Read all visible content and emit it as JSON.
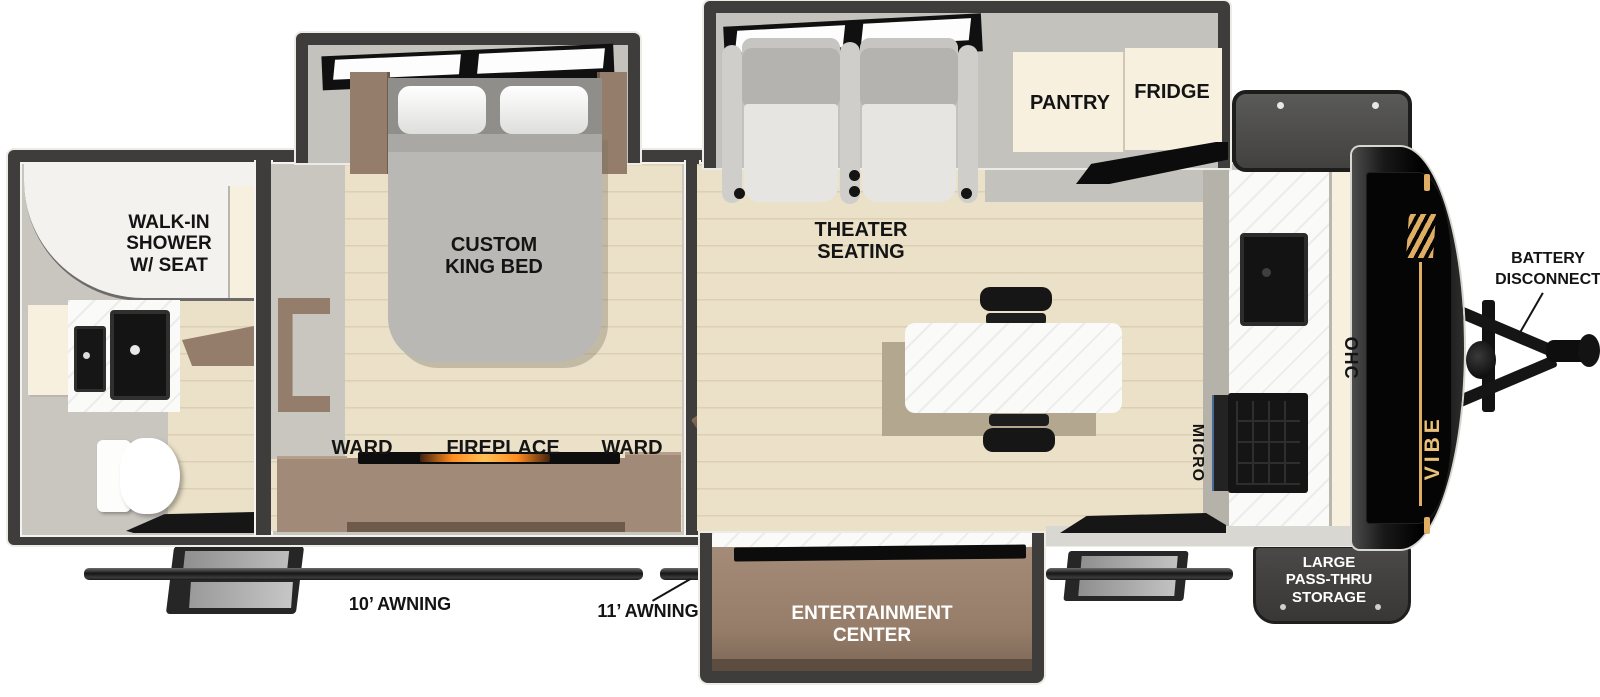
{
  "brand": {
    "logo": "VIBE"
  },
  "colors": {
    "wall": "#3e3d3b",
    "floor_wood": "#ebe1c8",
    "cabinet_cream": "#f7f0df",
    "furniture_brown": "#957d6b",
    "accent_gold": "#dfae62",
    "label_black": "#141414"
  },
  "bathroom": {
    "shower_l1": "WALK-IN",
    "shower_l2": "SHOWER",
    "shower_l3": "W/ SEAT"
  },
  "bedroom": {
    "bed_l1": "CUSTOM",
    "bed_l2": "KING BED",
    "ward_left": "WARD",
    "fireplace": "FIREPLACE",
    "ward_right": "WARD"
  },
  "living": {
    "theater_l1": "THEATER",
    "theater_l2": "SEATING",
    "pantry": "PANTRY",
    "fridge": "FRIDGE",
    "micro": "MICRO",
    "ohc": "OHC"
  },
  "exterior": {
    "battery_l1": "BATTERY",
    "battery_l2": "DISCONNECT",
    "awning_left": "10’ AWNING",
    "awning_right": "11’ AWNING",
    "entertainment_l1": "ENTERTAINMENT",
    "entertainment_l2": "CENTER",
    "storage_l1": "LARGE",
    "storage_l2": "PASS-THRU",
    "storage_l3": "STORAGE"
  }
}
